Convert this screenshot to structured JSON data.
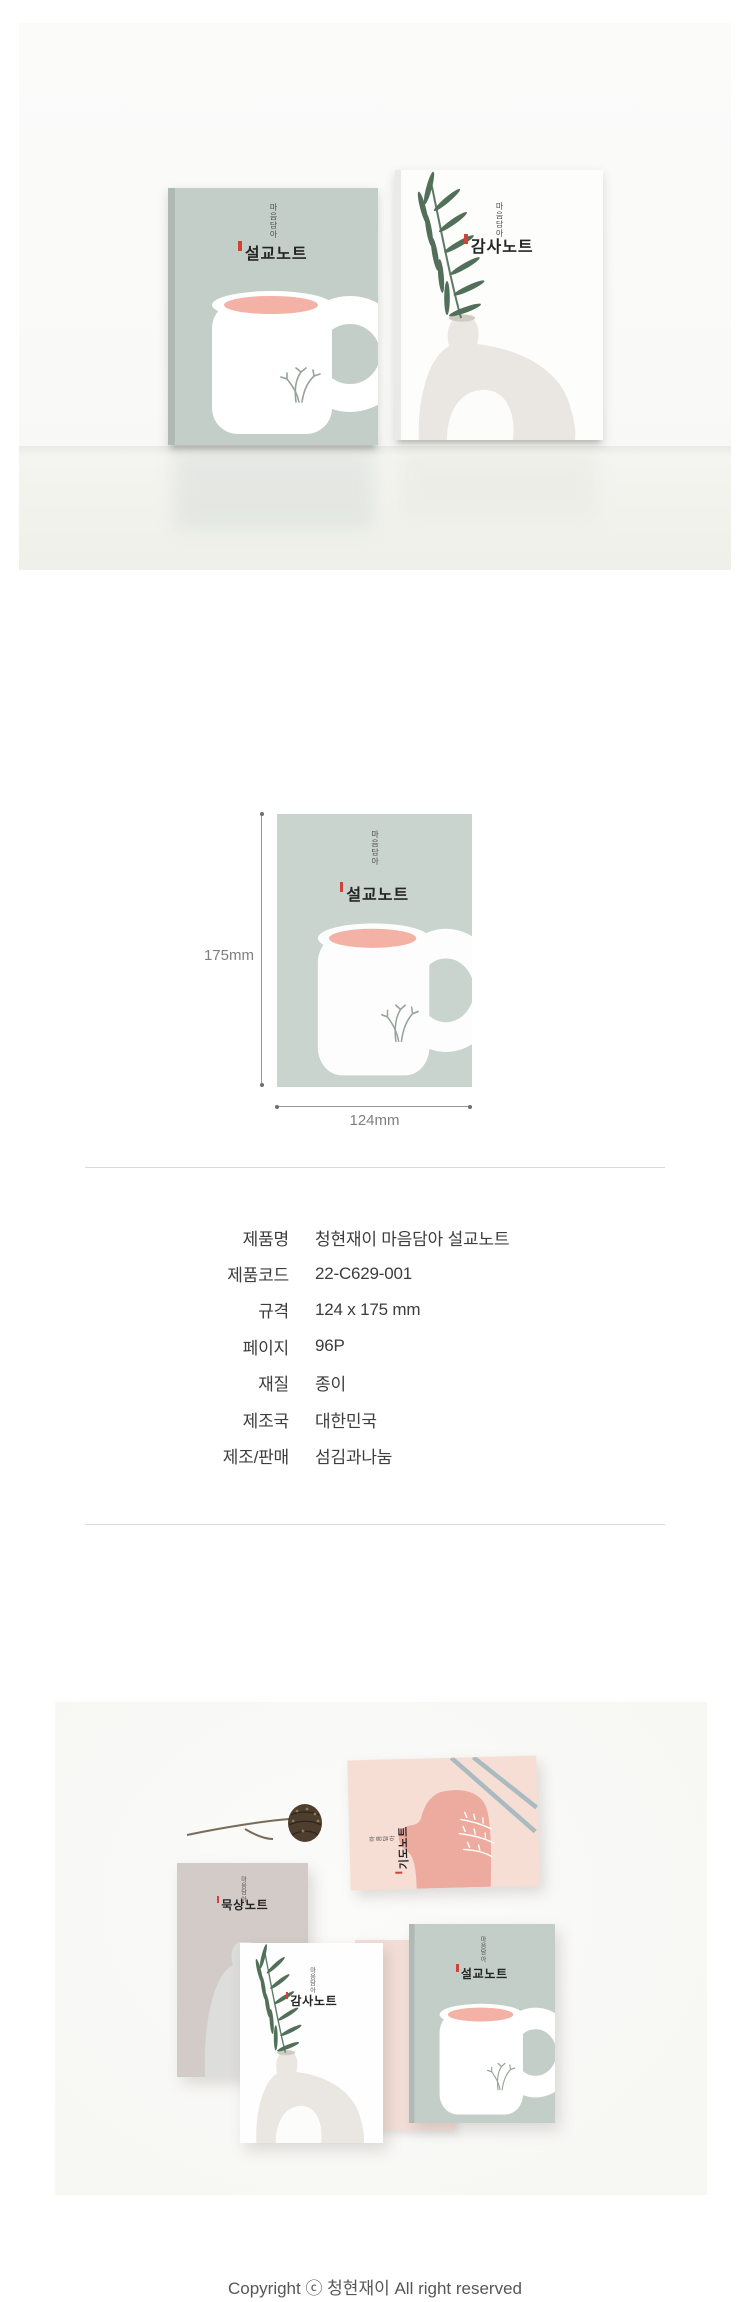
{
  "products": {
    "brand_tagline": "마음담아",
    "sermon": {
      "title": "설교노트"
    },
    "thanks": {
      "title": "감사노트"
    },
    "meditation": {
      "title": "묵상노트"
    },
    "prayer": {
      "title": "기도노트"
    }
  },
  "size_diagram": {
    "height_label": "175mm",
    "width_label": "124mm"
  },
  "spec_table": {
    "rows": [
      {
        "label": "제품명",
        "value": "청현재이 마음담아 설교노트"
      },
      {
        "label": "제품코드",
        "value": "22-C629-001"
      },
      {
        "label": "규격",
        "value": "124 x 175 mm"
      },
      {
        "label": "페이지",
        "value": "96P"
      },
      {
        "label": "재질",
        "value": "종이"
      },
      {
        "label": "제조국",
        "value": "대한민국"
      },
      {
        "label": "제조/판매",
        "value": "섬김과나눔"
      }
    ]
  },
  "footer": {
    "copyright": "Copyright ⓒ 청현재이 All right reserved"
  },
  "colors": {
    "sage_cover": "#c3cec8",
    "sage_cover_diagram": "#cad4ce",
    "mug_pink": "#f3b2a5",
    "leaf_green": "#527059",
    "white_cover": "#fdfdfc",
    "beige_cover": "#d3cbc7",
    "pink_cover": "#f7ded5",
    "pink_blob": "#ecab9e",
    "blue_gray_line": "#a9bbc0",
    "red_tick": "#cf4436",
    "spec_text": "#3d3d3d",
    "dimension_text": "#7f7f7f",
    "divider": "#d9d9d9",
    "copyright_text": "#575757"
  }
}
